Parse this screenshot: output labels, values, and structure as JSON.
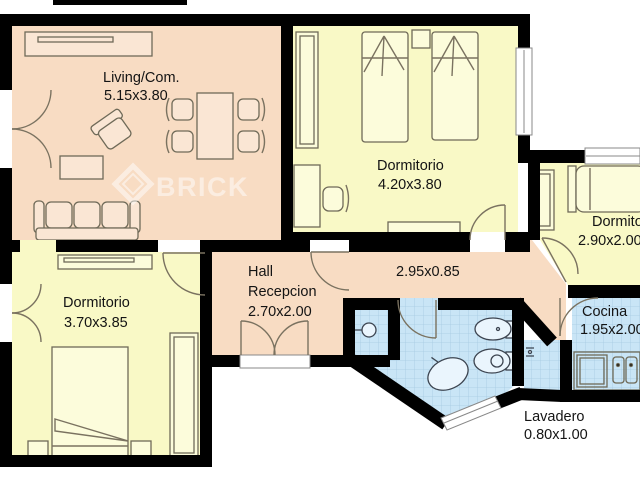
{
  "plan": {
    "watermark": {
      "text": "BRICK"
    },
    "colors": {
      "wall": "#000000",
      "living_pink": "#f8dcc3",
      "bedroom_yellow": "#f9f9c6",
      "wet_blue": "#c9e5f6",
      "tile_line": "#a6cbe1",
      "furniture_line": "#6f6a58"
    },
    "rooms": {
      "living": {
        "name": "Living/Com.",
        "dims": "5.15x3.80"
      },
      "dorm1": {
        "name": "Dormitorio",
        "dims": "4.20x3.80"
      },
      "dorm2": {
        "name": "Dormitorio",
        "dims": "2.90x2.00"
      },
      "dorm3": {
        "name": "Dormitorio",
        "dims": "3.70x3.85"
      },
      "hall": {
        "name": "Hall",
        "name2": "Recepcion",
        "dims": "2.70x2.00"
      },
      "corridor": {
        "dims": "2.95x0.85"
      },
      "cocina": {
        "name": "Cocina",
        "dims": "1.95x2.00"
      },
      "lavadero": {
        "name": "Lavadero",
        "dims": "0.80x1.00"
      }
    }
  }
}
